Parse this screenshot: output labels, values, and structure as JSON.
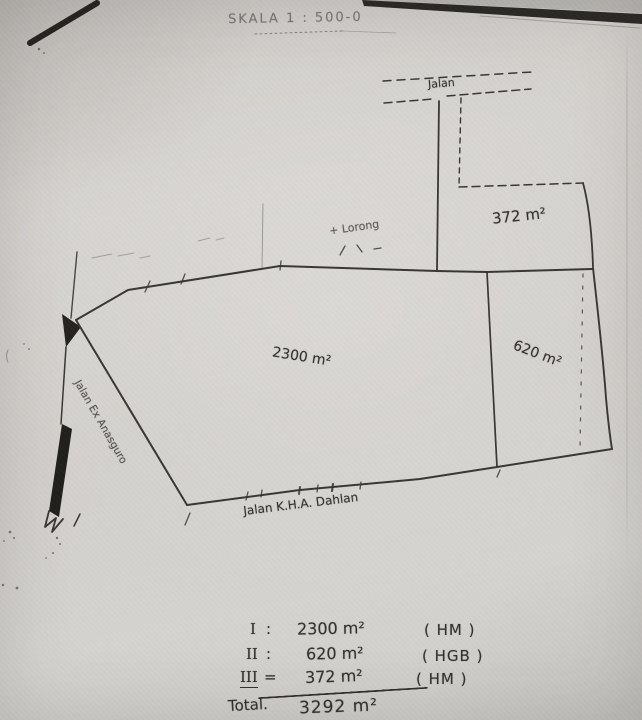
{
  "document": {
    "scale_note": "SKALA 1 : 500-0"
  },
  "map": {
    "roads": {
      "top_label": "Jalan",
      "left_label": "Jalan Ex Anasguro",
      "bottom_label": "Jalan K.H.A. Dahlan"
    },
    "annotation_label": "+ Lorong",
    "parcels": [
      {
        "id": "I",
        "area_label": "2300 m²"
      },
      {
        "id": "II",
        "area_label": "620 m²"
      },
      {
        "id": "III",
        "area_label": "372 m²"
      }
    ]
  },
  "summary": {
    "rows": [
      {
        "roman": "I",
        "sep": ":",
        "value": "2300 m²",
        "tenure": "( HM )"
      },
      {
        "roman": "II",
        "sep": ":",
        "value": "620 m²",
        "tenure": "( HGB )"
      },
      {
        "roman": "III",
        "sep": "=",
        "value": "372 m²",
        "tenure": "( HM )"
      }
    ],
    "total_label": "Total.",
    "total_value": "3292 m²"
  },
  "colors": {
    "ink": "#34312d",
    "paper": "#d3d0cc",
    "artifact_black": "#24211d"
  }
}
